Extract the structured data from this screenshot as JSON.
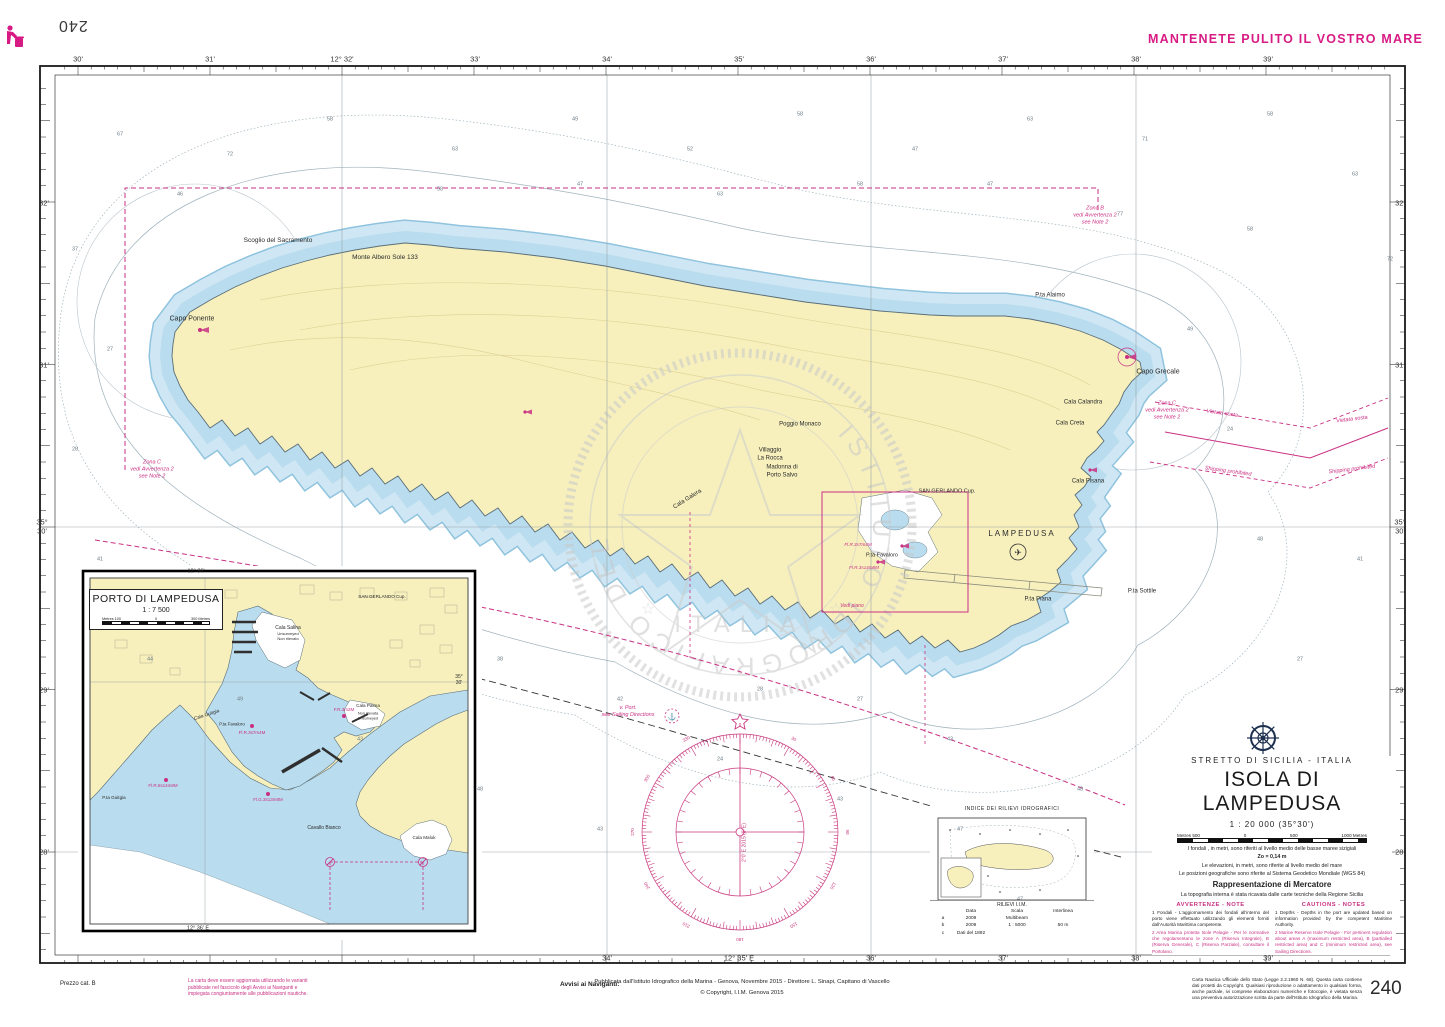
{
  "page": {
    "number_top": "240",
    "number_bottom": "240"
  },
  "header": {
    "slogan": "MANTENETE PULITO IL VOSTRO MARE"
  },
  "colors": {
    "magenta": "#c93183",
    "land": "#f7f0bd",
    "shallow": "#b9dcee",
    "deep_contour": "#9fb2bc"
  },
  "title_block": {
    "region": "STRETTO DI SICILIA - ITALIA",
    "title": "ISOLA DI LAMPEDUSA",
    "scale": "1 : 20 000   (35°30')",
    "scalebar": {
      "left": "Metres 500",
      "zero": "0",
      "mid": "500",
      "right": "1000 Metres"
    },
    "depths_note": "I fondali , in metri, sono riferiti al livello medio delle basse maree sizigiali",
    "zo_note": "Zo = 0,14 m",
    "elev_note": "Le elevazioni, in metri, sono riferite al livello medio del mare",
    "geo_note": "Le posizioni geografiche sono riferite al Sistema Geodetico Mondiale (WGS 84)",
    "projection": "Rappresentazione di Mercatore",
    "topo_note": "La topografia interna è stata ricavata dalle carte tecniche della Regione Sicilia",
    "avvertenze_header": "AVVERTENZE - NOTE",
    "cautions_header": "CAUTIONS - NOTES",
    "note1_it": "1 Fondali - L'aggiornamento dei fondali all'interno del porto viene effettuato utilizzando gli elementi forniti dall'Autorità Marittima competente.",
    "note2_it": "2 Area Marina protetta Isole Pelagie - Per le normative che regolamentano le zone A (Riserva Integrale), B (Riserva Generale), C (Riserva Parziale), consultare il Portolano.",
    "note1_en": "1 Depths - Depths in the port are updated based on information provided by the competent Maritime Authority.",
    "note2_en": "2 Marine Reserve Isole Pelagie - For pertinent regulation about areas A (maximum restricted area), B (partialled restricted area) and C (minimum restricted area), see Sailing Directions."
  },
  "index_box": {
    "title": "INDICE DEI RILIEVI IDROGRAFICI",
    "table_title": "RILIEVI I.I.M.",
    "headers": {
      "data": "Data",
      "scala": "Scala",
      "inter": "Interlinea"
    },
    "rows": [
      {
        "letter": "a",
        "data": "2009",
        "scala": "Multibeam",
        "inter": ""
      },
      {
        "letter": "b",
        "data": "2009",
        "scala": "1 : 5000",
        "inter": "50 m"
      },
      {
        "letter": "c",
        "data": "Dati del 1892",
        "scala": "",
        "inter": ""
      }
    ]
  },
  "inset": {
    "name": "PORTO DI LAMPEDUSA",
    "scale": "1 : 7 500",
    "scalebar": {
      "left": "Metres 100",
      "zero": "0",
      "right": "300 Metres"
    },
    "labels": [
      {
        "x": 382,
        "y": 597,
        "t": "SAN GERLANDO   Cup.",
        "s": 4.6
      },
      {
        "x": 288,
        "y": 628,
        "t": "Cala Salina",
        "s": 5
      },
      {
        "x": 288,
        "y": 636,
        "t": "Unsurveyed\nNon rilevato",
        "s": 4
      },
      {
        "x": 368,
        "y": 706,
        "t": "Cala Palma",
        "s": 4.6
      },
      {
        "x": 368,
        "y": 716,
        "t": "Non rilevata\nUnsurveyed",
        "s": 3.8
      },
      {
        "x": 207,
        "y": 716,
        "t": "Cala Guitgia",
        "s": 4.8,
        "r": -18
      },
      {
        "x": 232,
        "y": 724,
        "t": "P.ta Favaloro",
        "s": 4.4
      },
      {
        "x": 114,
        "y": 798,
        "t": "P.ta Guitgia",
        "s": 4.6
      },
      {
        "x": 324,
        "y": 828,
        "t": "Cavallo Bianco",
        "s": 5
      },
      {
        "x": 424,
        "y": 838,
        "t": "Cala Maluk",
        "s": 4.6
      },
      {
        "x": 196,
        "y": 572,
        "t": "12° 36'",
        "s": 5.5
      },
      {
        "x": 198,
        "y": 929,
        "t": "12° 36' E",
        "s": 5.5
      },
      {
        "x": 459,
        "y": 680,
        "t": "35°\n30'",
        "s": 5
      }
    ],
    "magenta_labels": [
      {
        "x": 252,
        "y": 733,
        "t": "Fl.R.3s7m4M"
      },
      {
        "x": 344,
        "y": 710,
        "t": "F.R.3m2M"
      },
      {
        "x": 268,
        "y": 800,
        "t": "Fl.G.3s13m8M"
      },
      {
        "x": 163,
        "y": 786,
        "t": "Fl.R.5s14m8M"
      }
    ]
  },
  "compass": {
    "variation": "2°0' E 2015 (8' E)",
    "anchor_note": "v. Port.\nsee Sailing Directions",
    "degree_step": 30
  },
  "footer": {
    "prezzo": "Prezzo cat. B",
    "update_note": "La carta deve essere aggiornata utilizzando le varianti\npubblicate nel fascicolo degli Avvisi ai Naviganti e\nimpiegata congiuntamente alle pubblicazioni nautiche.",
    "avvisi": "Avvisi ai Naviganti:",
    "published": "Pubblicata dall'Istituto Idrografico della Marina - Genova, Novembre 2015 - Direttore L. Sinapi, Capitano di Vascello",
    "copyright": "© Copyright, I.I.M. Genova 2015",
    "legal": "Carta Nautica Ufficiale dello Stato (Legge 2.2.1960 N. 68). Questa carta contiene dati protetti da Copyright. Qualsiasi riproduzione o adattamento in qualsiasi forma, anche parziale, ivi comprese elaborazioni numeriche e fotocopie, è vietata senza una preventiva autorizzazione scritta da parte dell'Istituto Idrografico della Marina."
  },
  "watermark": {
    "ring_text": "ISTITUTO IDROGRAFICO DELLA MARINA",
    "bottom_text": "ITALIA"
  },
  "map": {
    "edge_top": [
      {
        "x": 78,
        "y": 59,
        "t": "30'"
      },
      {
        "x": 210,
        "y": 59,
        "t": "31'"
      },
      {
        "x": 342,
        "y": 59,
        "t": "12° 32'"
      },
      {
        "x": 475,
        "y": 59,
        "t": "33'"
      },
      {
        "x": 607,
        "y": 59,
        "t": "34'"
      },
      {
        "x": 739,
        "y": 59,
        "t": "35'"
      },
      {
        "x": 871,
        "y": 59,
        "t": "36'"
      },
      {
        "x": 1003,
        "y": 59,
        "t": "37'"
      },
      {
        "x": 1136,
        "y": 59,
        "t": "38'"
      },
      {
        "x": 1268,
        "y": 59,
        "t": "39'"
      }
    ],
    "edge_bottom": [
      {
        "x": 607,
        "y": 958,
        "t": "34'"
      },
      {
        "x": 739,
        "y": 958,
        "t": "12° 35' E"
      },
      {
        "x": 871,
        "y": 958,
        "t": "36'"
      },
      {
        "x": 1003,
        "y": 958,
        "t": "37'"
      },
      {
        "x": 1136,
        "y": 958,
        "t": "38'"
      },
      {
        "x": 1268,
        "y": 958,
        "t": "39'"
      }
    ],
    "edge_left": [
      {
        "x": 44,
        "y": 203,
        "t": "32'"
      },
      {
        "x": 44,
        "y": 365,
        "t": "31'"
      },
      {
        "x": 42,
        "y": 527,
        "t": "35°\n30'"
      },
      {
        "x": 44,
        "y": 690,
        "t": "29'"
      },
      {
        "x": 44,
        "y": 852,
        "t": "28'"
      }
    ],
    "edge_right": [
      {
        "x": 1400,
        "y": 203,
        "t": "32'"
      },
      {
        "x": 1400,
        "y": 365,
        "t": "31'"
      },
      {
        "x": 1400,
        "y": 527,
        "t": "35°\n30'"
      },
      {
        "x": 1400,
        "y": 690,
        "t": "29'"
      },
      {
        "x": 1400,
        "y": 852,
        "t": "28'"
      }
    ],
    "place_labels": [
      {
        "x": 192,
        "y": 320,
        "t": "Capo Ponente",
        "s": 7
      },
      {
        "x": 278,
        "y": 241,
        "t": "Scoglio del Sacramento"
      },
      {
        "x": 385,
        "y": 258,
        "t": "Monte Albero Sole  133"
      },
      {
        "x": 770,
        "y": 455,
        "t": "Villaggio\nLa Rocca",
        "s": 6
      },
      {
        "x": 782,
        "y": 472,
        "t": "Madonna di\nPorto Salvo",
        "s": 6
      },
      {
        "x": 800,
        "y": 425,
        "t": "Poggio Monaco",
        "s": 6
      },
      {
        "x": 1050,
        "y": 296,
        "t": "P.ta Alaimo",
        "s": 6
      },
      {
        "x": 1158,
        "y": 373,
        "t": "Capo Grecale",
        "s": 7
      },
      {
        "x": 1083,
        "y": 403,
        "t": "Cala Calandra",
        "s": 6
      },
      {
        "x": 1070,
        "y": 424,
        "t": "Cala Creta",
        "s": 6
      },
      {
        "x": 1088,
        "y": 482,
        "t": "Cala Pisana",
        "s": 6
      },
      {
        "x": 1142,
        "y": 592,
        "t": "P.ta Sottile",
        "s": 6
      },
      {
        "x": 1038,
        "y": 600,
        "t": "P.ta Piana",
        "s": 6
      },
      {
        "x": 1022,
        "y": 534,
        "t": "LAMPEDUSA",
        "s": 8,
        "ls": 2
      },
      {
        "x": 947,
        "y": 492,
        "t": "SAN GERLANDO   Cup.",
        "s": 5.5
      },
      {
        "x": 882,
        "y": 556,
        "t": "P.ta Favaloro",
        "s": 5.5
      },
      {
        "x": 688,
        "y": 500,
        "t": "Cala Galera",
        "s": 6,
        "r": -32
      }
    ],
    "magenta_labels": [
      {
        "x": 1095,
        "y": 216,
        "t": "Zona B\nvedi Avvertenza 2\nsee Note 2"
      },
      {
        "x": 1167,
        "y": 411,
        "t": "Zona C\nvedi Avvertenza 2\nsee Note 2"
      },
      {
        "x": 152,
        "y": 470,
        "t": "Zona C\nvedi Avvertenza 2\nsee Note 2"
      },
      {
        "x": 1222,
        "y": 414,
        "t": "Vietata   sosta",
        "r": 8
      },
      {
        "x": 1352,
        "y": 420,
        "t": "Vietata   sosta",
        "r": -7
      },
      {
        "x": 1228,
        "y": 472,
        "t": "Shipping   prohibited",
        "r": 8
      },
      {
        "x": 1352,
        "y": 470,
        "t": "Shipping   prohibited",
        "r": -7
      },
      {
        "x": 858,
        "y": 545,
        "t": "Fl.R.3s7m4M",
        "s": 4.6
      },
      {
        "x": 864,
        "y": 568,
        "t": "Fl.R.3s14m8M",
        "s": 4.6
      },
      {
        "x": 852,
        "y": 606,
        "t": "Vedi piano",
        "s": 5
      },
      {
        "x": 628,
        "y": 712,
        "t": "v. Port.\nsee Sailing Directions"
      }
    ],
    "soundings": [
      {
        "x": 120,
        "y": 135,
        "t": "67"
      },
      {
        "x": 230,
        "y": 155,
        "t": "72"
      },
      {
        "x": 330,
        "y": 120,
        "t": "58"
      },
      {
        "x": 455,
        "y": 150,
        "t": "63"
      },
      {
        "x": 575,
        "y": 120,
        "t": "49"
      },
      {
        "x": 690,
        "y": 150,
        "t": "52"
      },
      {
        "x": 800,
        "y": 115,
        "t": "58"
      },
      {
        "x": 915,
        "y": 150,
        "t": "47"
      },
      {
        "x": 1030,
        "y": 120,
        "t": "63"
      },
      {
        "x": 1145,
        "y": 140,
        "t": "71"
      },
      {
        "x": 1270,
        "y": 115,
        "t": "58"
      },
      {
        "x": 1355,
        "y": 175,
        "t": "63"
      },
      {
        "x": 1390,
        "y": 260,
        "t": "72"
      },
      {
        "x": 75,
        "y": 250,
        "t": "37"
      },
      {
        "x": 110,
        "y": 350,
        "t": "27"
      },
      {
        "x": 75,
        "y": 450,
        "t": "28"
      },
      {
        "x": 100,
        "y": 560,
        "t": "41"
      },
      {
        "x": 150,
        "y": 660,
        "t": "44"
      },
      {
        "x": 240,
        "y": 700,
        "t": "49"
      },
      {
        "x": 360,
        "y": 740,
        "t": "43"
      },
      {
        "x": 480,
        "y": 790,
        "t": "48"
      },
      {
        "x": 600,
        "y": 830,
        "t": "43"
      },
      {
        "x": 620,
        "y": 700,
        "t": "42"
      },
      {
        "x": 500,
        "y": 660,
        "t": "38"
      },
      {
        "x": 720,
        "y": 760,
        "t": "24"
      },
      {
        "x": 840,
        "y": 800,
        "t": "43"
      },
      {
        "x": 960,
        "y": 830,
        "t": "47"
      },
      {
        "x": 1080,
        "y": 790,
        "t": "48"
      },
      {
        "x": 1200,
        "y": 820,
        "t": "49"
      },
      {
        "x": 1320,
        "y": 760,
        "t": "58"
      },
      {
        "x": 1300,
        "y": 660,
        "t": "27"
      },
      {
        "x": 1360,
        "y": 560,
        "t": "41"
      },
      {
        "x": 1260,
        "y": 540,
        "t": "48"
      },
      {
        "x": 1230,
        "y": 430,
        "t": "24"
      },
      {
        "x": 1190,
        "y": 330,
        "t": "49"
      },
      {
        "x": 1250,
        "y": 230,
        "t": "58"
      },
      {
        "x": 1120,
        "y": 215,
        "t": "77"
      },
      {
        "x": 990,
        "y": 185,
        "t": "47"
      },
      {
        "x": 860,
        "y": 185,
        "t": "58"
      },
      {
        "x": 720,
        "y": 195,
        "t": "63"
      },
      {
        "x": 580,
        "y": 185,
        "t": "47"
      },
      {
        "x": 440,
        "y": 190,
        "t": "58"
      },
      {
        "x": 180,
        "y": 195,
        "t": "46"
      },
      {
        "x": 950,
        "y": 740,
        "t": "43"
      },
      {
        "x": 860,
        "y": 700,
        "t": "27"
      },
      {
        "x": 1330,
        "y": 880,
        "t": "58"
      },
      {
        "x": 1020,
        "y": 900,
        "t": "47"
      },
      {
        "x": 760,
        "y": 690,
        "t": "28"
      }
    ]
  }
}
